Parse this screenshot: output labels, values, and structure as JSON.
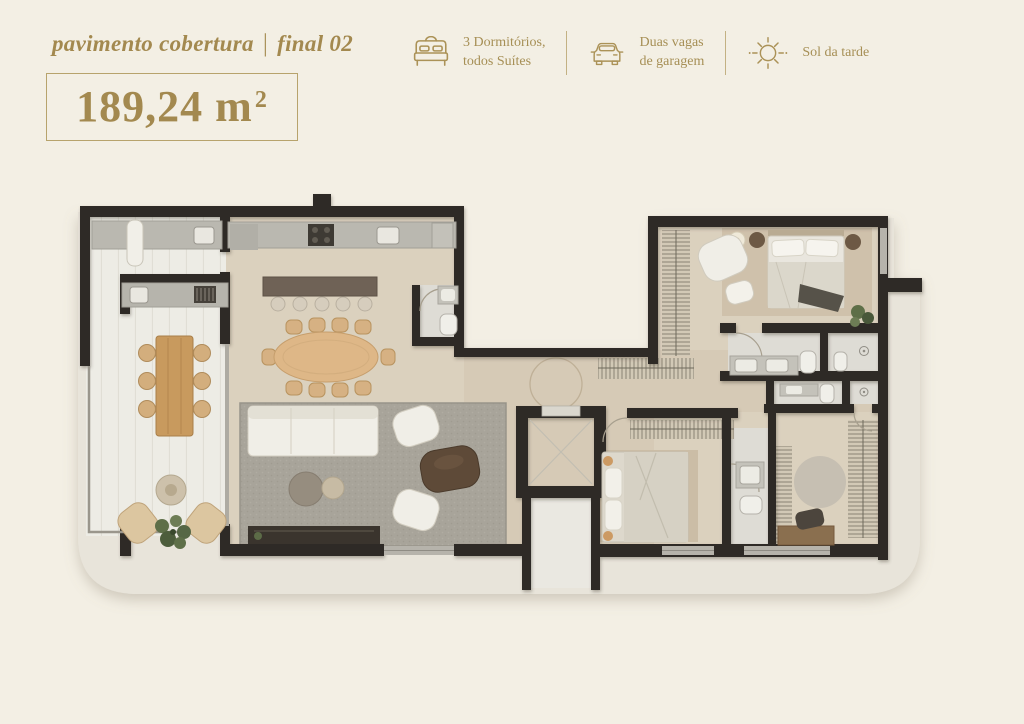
{
  "header": {
    "title_prefix": "pavimento cobertura",
    "title_separator": "|",
    "title_suffix": "final 02",
    "area_value": "189,24 m",
    "area_sup": "2"
  },
  "features": {
    "bedrooms": {
      "icon": "bed-icon",
      "line1": "3 Dormitórios,",
      "line2": "todos Suítes"
    },
    "parking": {
      "icon": "car-icon",
      "line1": "Duas vagas",
      "line2": "de garagem"
    },
    "sunlight": {
      "icon": "sun-icon",
      "line1": "Sol da tarde",
      "line2": ""
    }
  },
  "colors": {
    "background": "#f3efe4",
    "accent_gold": "#a3894f",
    "box_border": "#b7a36c",
    "wall": "#2e2925",
    "slab": "#e8e4da",
    "floor_beige": "#dbd1be",
    "terrace_floor": "#edece5",
    "bathroom_floor": "#dedcd5",
    "rug_gray": "#a8a49a",
    "wood_table": "#c89a5e",
    "dining_table": "#deb787"
  }
}
